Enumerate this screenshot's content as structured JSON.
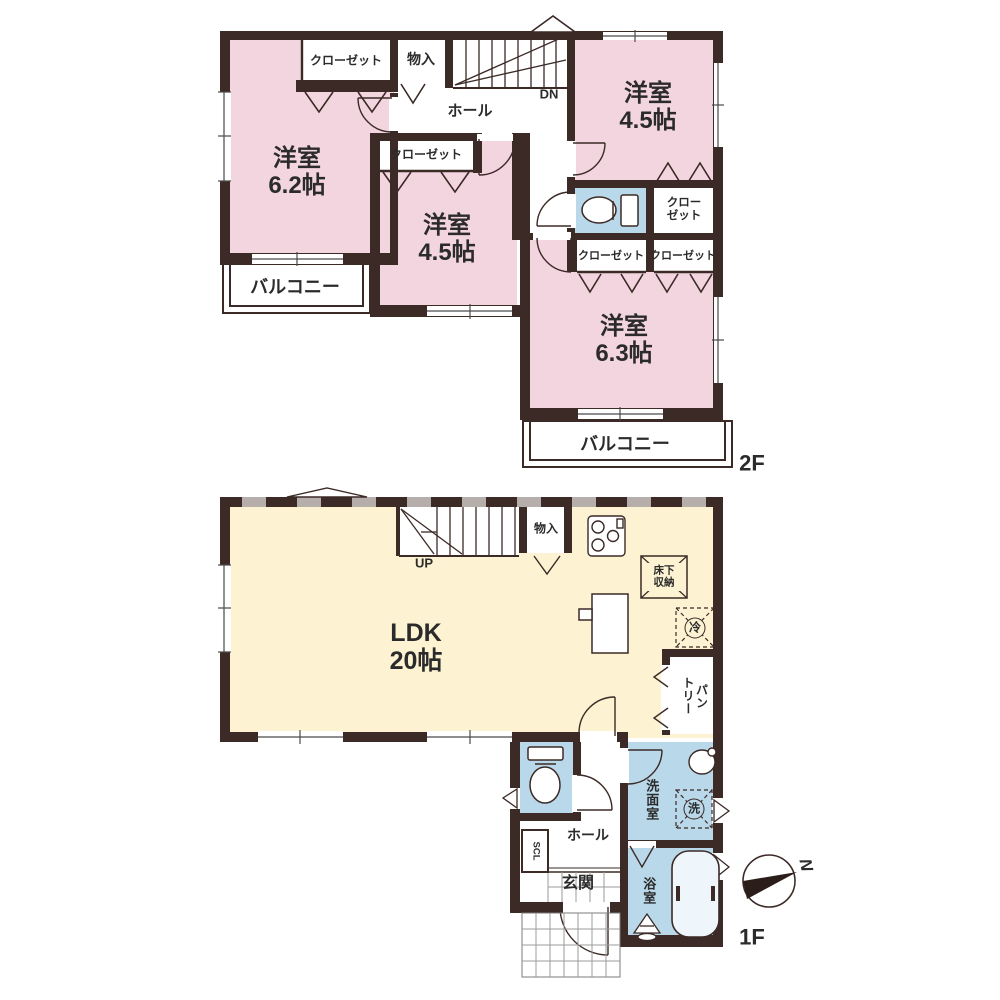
{
  "colors": {
    "wall": "#3b2a26",
    "room_pink": "#f3d5e0",
    "wet_blue": "#b9d8ea",
    "ldk_cream": "#fdf3d2",
    "text": "#2b2b2b"
  },
  "floor2": {
    "label": "2F",
    "rooms": {
      "west": {
        "name": "洋室",
        "area": "6.2帖"
      },
      "center": {
        "name": "洋室",
        "area": "4.5帖"
      },
      "northeast": {
        "name": "洋室",
        "area": "4.5帖"
      },
      "southeast": {
        "name": "洋室",
        "area": "6.3帖"
      }
    },
    "closets": {
      "west": "クローゼット",
      "center": "クローゼット",
      "northeast": {
        "line1": "クロー",
        "line2": "ゼット"
      },
      "southeast_left": "クローゼット",
      "southeast_right": "クローゼット"
    },
    "storage": "物入",
    "hall": "ホール",
    "stairs": "DN",
    "balcony_west": "バルコニー",
    "balcony_south": "バルコニー"
  },
  "floor1": {
    "label": "1F",
    "ldk": {
      "name": "LDK",
      "area": "20帖"
    },
    "stairs": "UP",
    "storage": "物入",
    "underfloor_storage": {
      "line1": "床下",
      "line2": "収納"
    },
    "refrigerator": "冷",
    "pantry": {
      "line1": "パン",
      "line2": "トリー"
    },
    "hall": "ホール",
    "shoe_closet": "SCL",
    "entrance": "玄関",
    "washroom": "洗面室",
    "laundry": "洗",
    "bathroom": "浴室"
  },
  "compass": {
    "north": "N"
  }
}
